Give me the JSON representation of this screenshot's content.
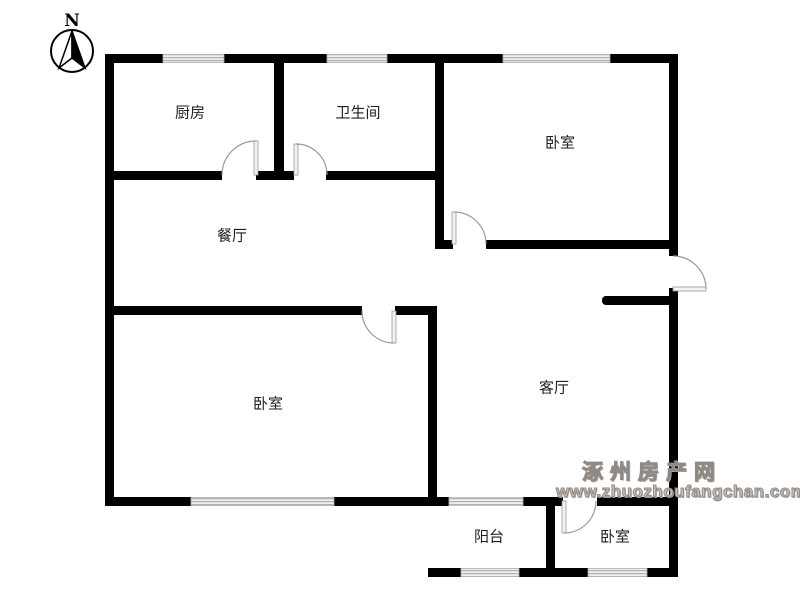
{
  "compass": {
    "label": "N"
  },
  "rooms": {
    "kitchen": {
      "label": "厨房"
    },
    "bathroom": {
      "label": "卫生间"
    },
    "bedroom_top": {
      "label": "卧室"
    },
    "dining": {
      "label": "餐厅"
    },
    "bedroom_left": {
      "label": "卧室"
    },
    "living": {
      "label": "客厅"
    },
    "balcony": {
      "label": "阳台"
    },
    "bedroom_bottom": {
      "label": "卧室"
    }
  },
  "watermark": {
    "site_name": "涿州房产网",
    "url": "www.zhuozhoufangchan.com",
    "color": "#9a948f"
  },
  "colors": {
    "wall": "#000000",
    "door": "#999999",
    "window": "#b0b0b0",
    "background": "#ffffff"
  }
}
